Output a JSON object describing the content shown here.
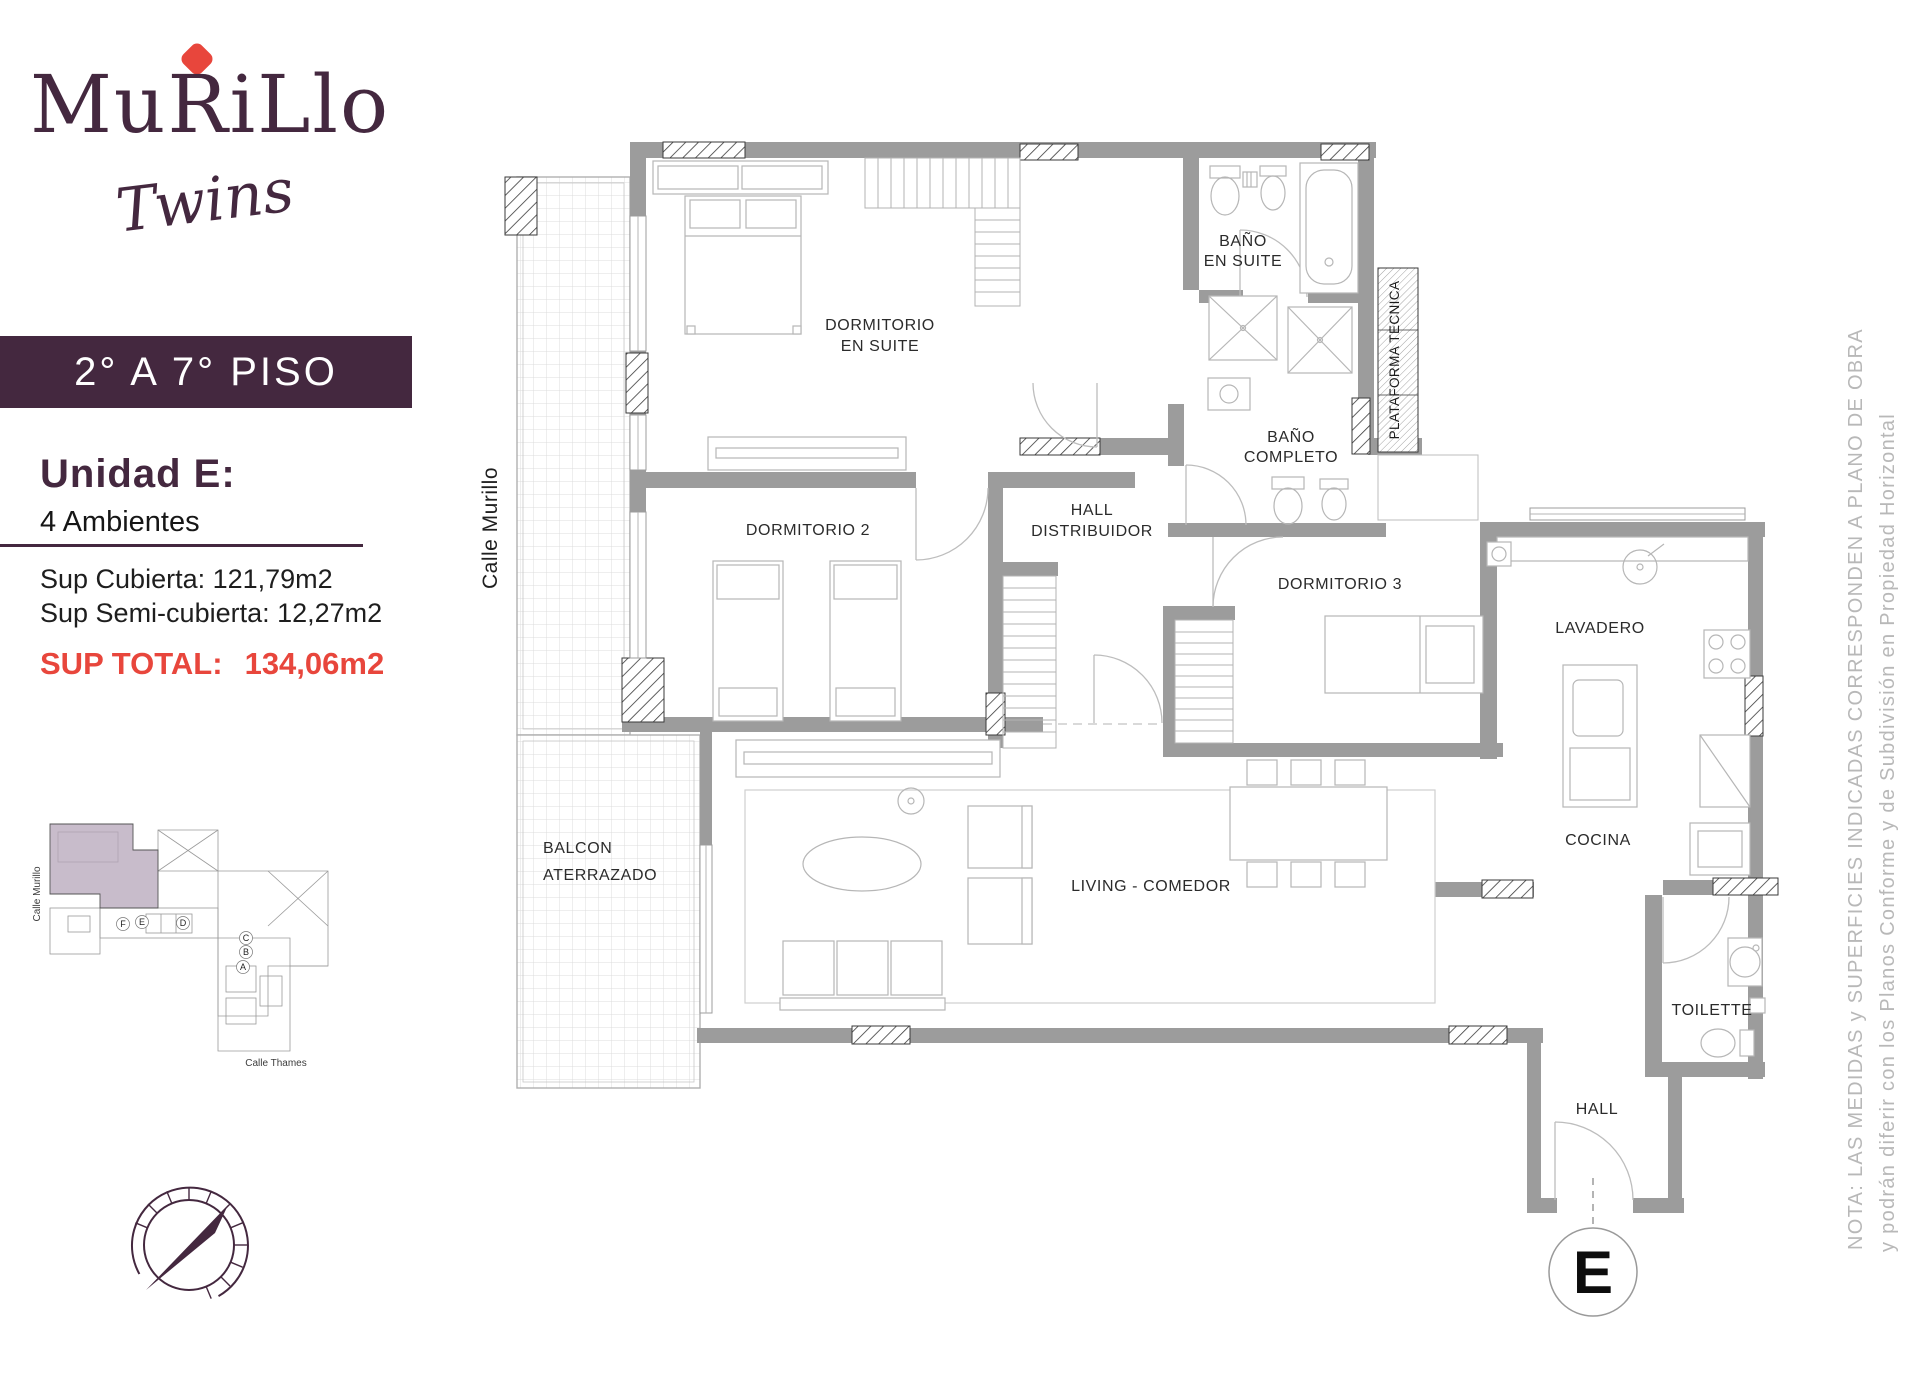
{
  "brand": {
    "name": "MuRiLlo",
    "tagline": "Twins"
  },
  "banner": {
    "label": "2° A 7° PISO"
  },
  "unit": {
    "title": "Unidad E:",
    "rooms_count": "4 Ambientes",
    "sup_cubierta": "Sup Cubierta: 121,79m2",
    "sup_semi": "Sup Semi-cubierta: 12,27m2",
    "sup_total_label": "SUP TOTAL:",
    "sup_total_value": "134,06m2"
  },
  "site_plan": {
    "street_left": "Calle Murillo",
    "street_bottom": "Calle Thames",
    "units": [
      "F",
      "E",
      "D",
      "C",
      "B",
      "A"
    ]
  },
  "plan": {
    "street_label": "Calle Murillo",
    "unit_marker": "E",
    "rooms": {
      "dorm_suite_1": "DORMITORIO",
      "dorm_suite_2": "EN SUITE",
      "bano_suite_1": "BAÑO",
      "bano_suite_2": "EN SUITE",
      "plataforma": "PLATAFORMA TECNICA",
      "bano_completo_1": "BAÑO",
      "bano_completo_2": "COMPLETO",
      "dorm2": "DORMITORIO 2",
      "hall_dist_1": "HALL",
      "hall_dist_2": "DISTRIBUIDOR",
      "dorm3": "DORMITORIO 3",
      "lavadero": "LAVADERO",
      "cocina": "COCINA",
      "balcon_1": "BALCON",
      "balcon_2": "ATERRAZADO",
      "living": "LIVING - COMEDOR",
      "toilette": "TOILETTE",
      "hall": "HALL"
    }
  },
  "note": {
    "line1": "NOTA: LAS MEDIDAS y SUPERFICIES INDICADAS CORRESPONDEN A PLANO DE OBRA",
    "line2": "y podrán diferir con los Planos Conforme y de Subdivisión en Propiedad Horizontal"
  },
  "colors": {
    "brand_purple": "#44283f",
    "accent_red": "#e8463c",
    "wall_gray": "#9c9c9c",
    "unit_highlight": "#b5a5ba",
    "note_gray": "#b8b8b8"
  }
}
